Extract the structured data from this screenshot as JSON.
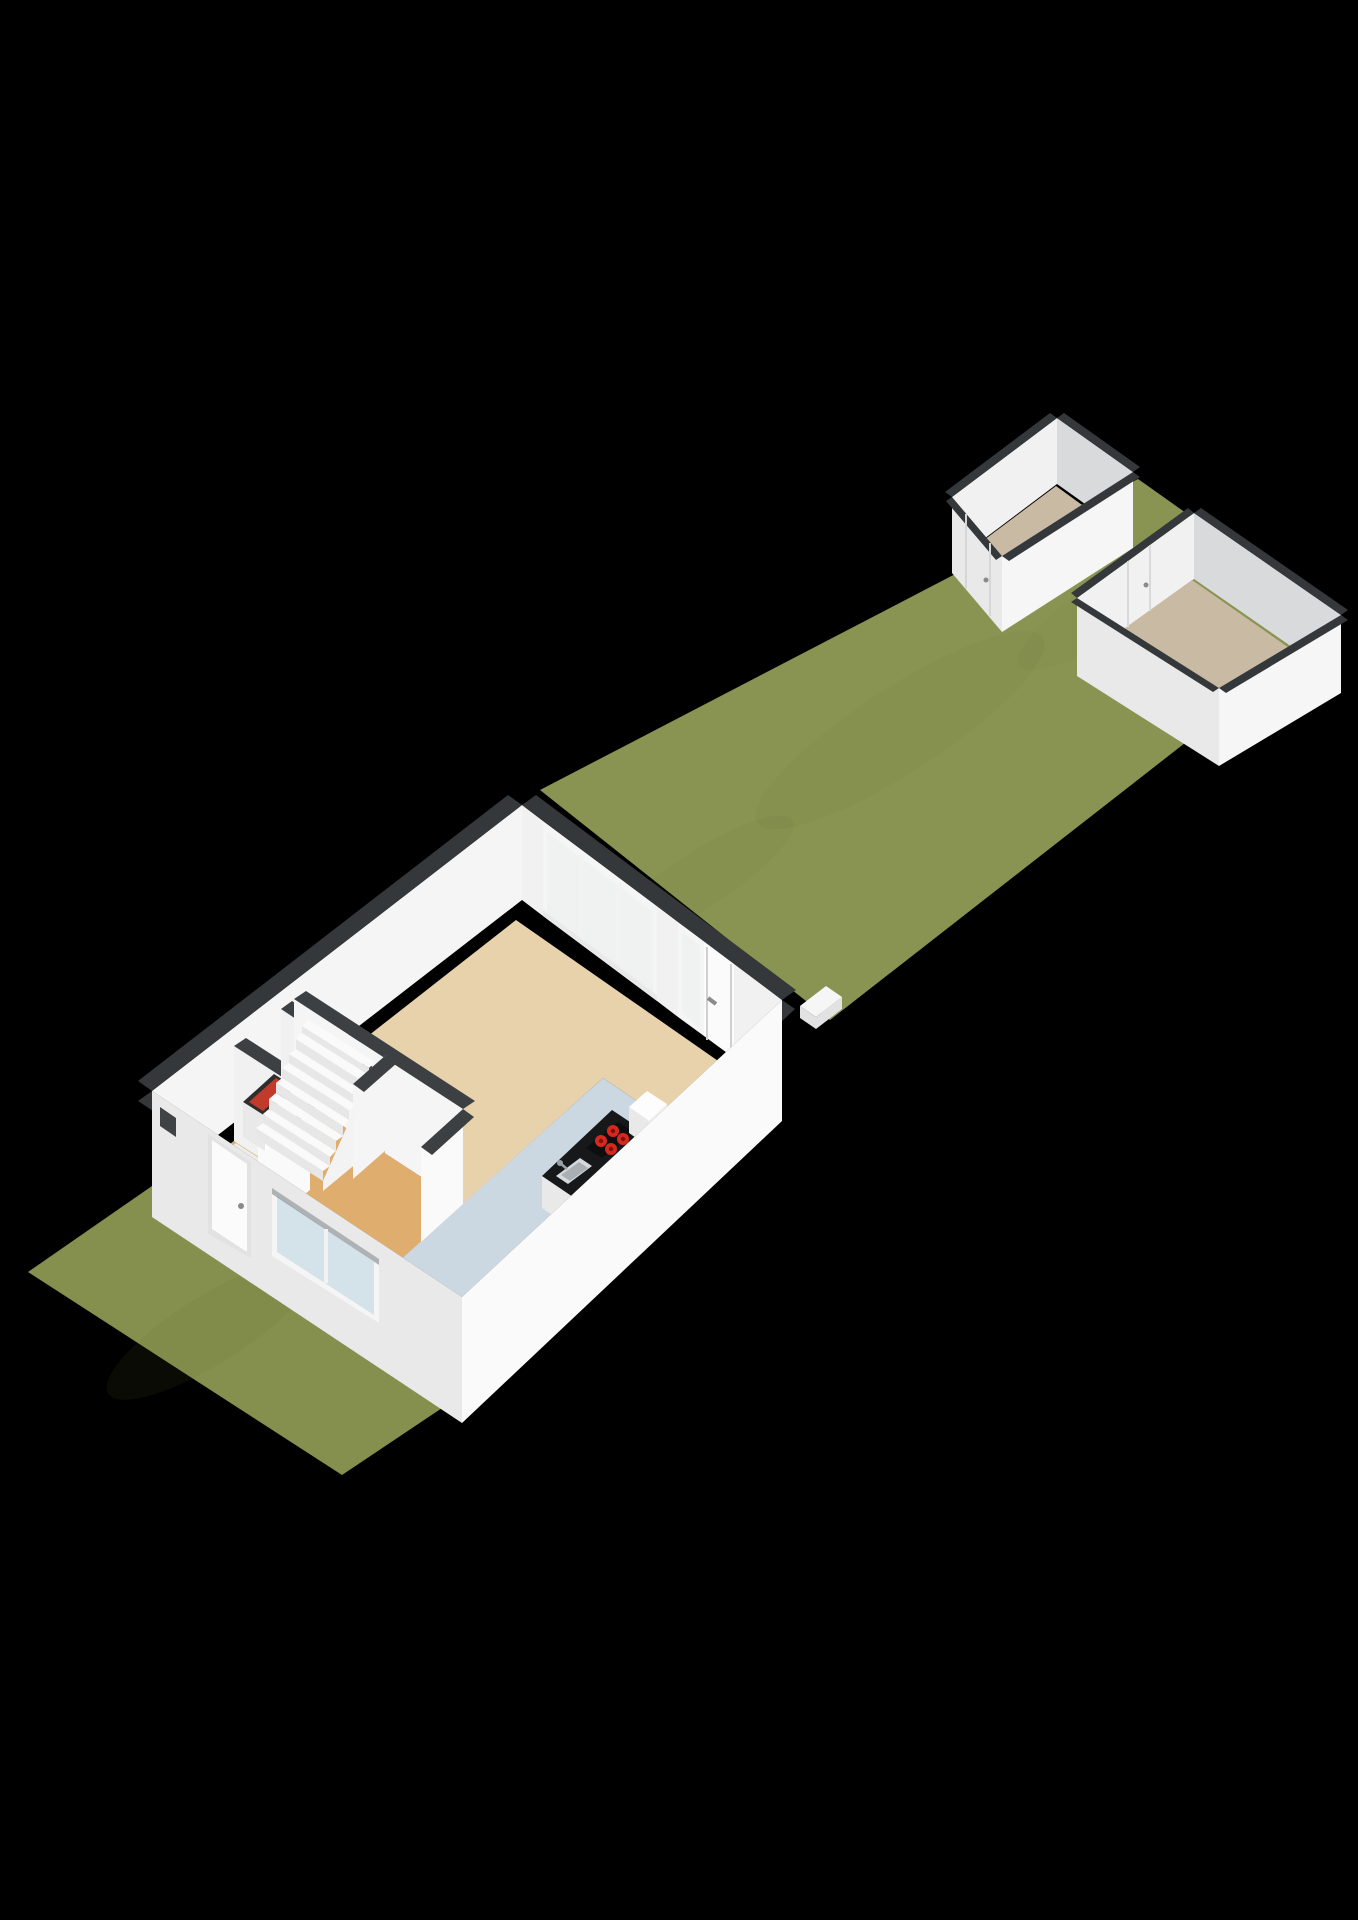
{
  "scene": {
    "name": "3d-floorplan-ground-floor-with-garden-and-two-sheds",
    "view": "isometric-dollhouse-render",
    "background": "#000000"
  },
  "colors": {
    "background": "#000000",
    "grassFront": "#85904e",
    "grassBack": "#8a9452",
    "grassShade": "#5f6b33",
    "capDark": "#35383b",
    "capDark2": "#3c4043",
    "wallWhite": "#f5f5f5",
    "wallBright": "#fafafa",
    "wallShade": "#e9e9e9",
    "wallGray": "#d8dadb",
    "wallInner": "#f1f1f1",
    "floorLiving": "#e8d2ac",
    "floorHall": "#dfae6e",
    "floorKitchen": "#cbd8e2",
    "floorToilet": "#ececec",
    "floorShed": "#c9baa4",
    "stringerWhite": "#f3f3f3",
    "treadWhite": "#fafafa",
    "riserShade": "#e7e7e7",
    "counterBlack": "#17181a",
    "cooktopBlack": "#0e0e0e",
    "burnerRed": "#d6281e",
    "burnerCore": "#7a120c",
    "sinkGray": "#d6dadd",
    "sinkInner": "#a9b0b5",
    "faucetGray": "#9aa1a6",
    "glassTint": "#e8f0ee",
    "windowGlass": "#d4e2ea",
    "doorWhite": "#fbfbfb",
    "doorFrame": "#e2e2e2",
    "handleGray": "#8a8a8a",
    "boilerWhite": "#fdfdfd",
    "boilerTop": "#2e2e2e",
    "boilerRed": "#c23b2a",
    "slitDark": "#3f4346",
    "revealShadow": "#6a6f73",
    "stepWhite": "#f6f6f6",
    "stepSide": "#e2e2e2"
  },
  "house": {
    "rooms": [
      "hallway",
      "toilet",
      "living-room",
      "kitchen"
    ],
    "stairs_steps": 8,
    "glass_door_panels": 4,
    "cooktop_burners": 4,
    "front_doors": 1,
    "garden_doors": 1,
    "windows": 2
  },
  "garden": {
    "front_yard": 1,
    "back_garden": 1
  },
  "outbuildings": {
    "count": 2,
    "shed_doors": 2
  }
}
